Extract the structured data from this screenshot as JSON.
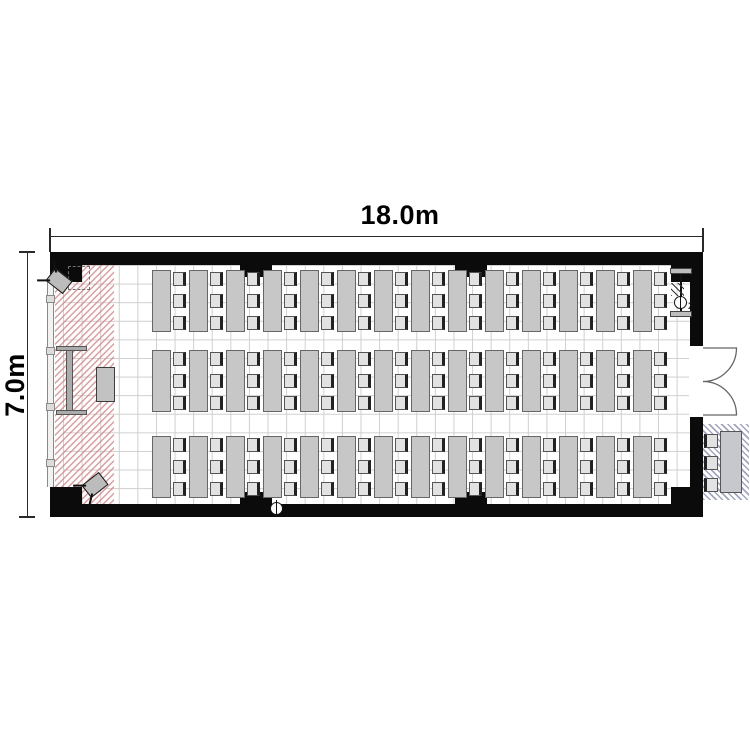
{
  "page": {
    "type": "classroom-floor-plan",
    "background": "#ffffff"
  },
  "dimensions": {
    "width_label": "18.0m",
    "height_label": "7.0m"
  },
  "room": {
    "stage": {
      "hatch_color": "#d97a7a",
      "items": [
        "screen",
        "lectern",
        "speaker",
        "speaker"
      ],
      "speakers": 2
    },
    "seating": {
      "rows": 3,
      "tables_per_row": 14,
      "chairs_per_table": 3,
      "total_seats": 126
    },
    "outlets": [
      {
        "label": "2"
      },
      {
        "label": "2"
      }
    ],
    "door": {
      "type": "double-swing",
      "wall": "right"
    },
    "reception": {
      "tables": 1,
      "chairs": 3,
      "hatch_color": "#8a8eb4"
    }
  },
  "colors": {
    "wall": "#0b0b0b",
    "grid": "#cfcfcf",
    "table_fill": "#c7c7c7",
    "table_border": "#666666",
    "chair_fill": "#e2e2e2"
  }
}
